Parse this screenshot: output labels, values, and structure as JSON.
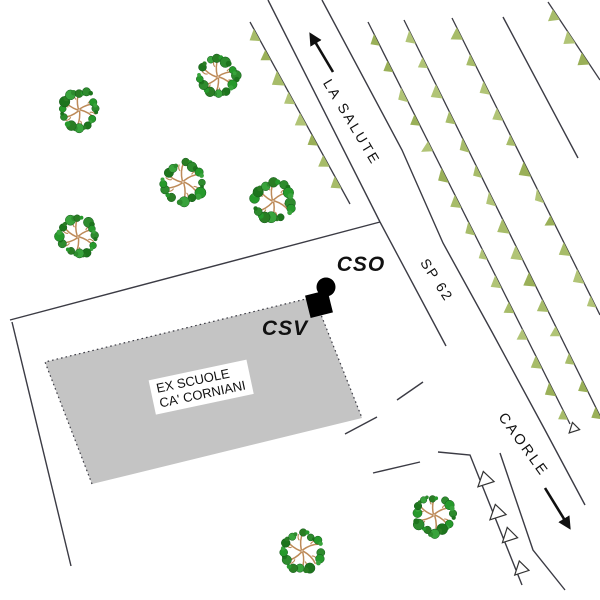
{
  "map": {
    "width": 600,
    "height": 600,
    "colors": {
      "background": "#ffffff",
      "line": "#3b3b44",
      "arrow": "#101010",
      "building_fill": "#c4c4c4",
      "building_outline": "#3b3b44",
      "marker": "#000000",
      "hedge_greens": [
        "#a7bc69",
        "#9ab058",
        "#b1c476"
      ],
      "tree_leaf_greens": [
        "#2e8b2e",
        "#26992b",
        "#1d741d",
        "#39a33c",
        "#2a7d24"
      ],
      "tree_branch": "#bd8a58",
      "white_triangle_fill": "#ffffff",
      "white_triangle_stroke": "#333333"
    },
    "labels": {
      "la_salute": {
        "text": "LA SALUTE",
        "x": 352,
        "y": 122,
        "rotate": 59,
        "size": 14,
        "spacing": 2.5,
        "weight": 400,
        "italic": false
      },
      "sp_62": {
        "text": "SP 62",
        "x": 437,
        "y": 280,
        "rotate": 57,
        "size": 14,
        "spacing": 2,
        "weight": 400,
        "italic": false
      },
      "caorle": {
        "text": "CAORLE",
        "x": 523,
        "y": 445,
        "rotate": 54,
        "size": 14.5,
        "spacing": 2.5,
        "weight": 400,
        "italic": false
      },
      "cso": {
        "text": "CSO",
        "x": 361,
        "y": 265,
        "rotate": 0,
        "size": 21,
        "spacing": 1,
        "weight": 700,
        "italic": true
      },
      "csv": {
        "text": "CSV",
        "x": 285,
        "y": 329,
        "rotate": 0,
        "size": 21,
        "spacing": 1,
        "weight": 700,
        "italic": true
      }
    },
    "building": {
      "points": [
        [
          45,
          362
        ],
        [
          314,
          297
        ],
        [
          362,
          418
        ],
        [
          92,
          484
        ]
      ],
      "label": {
        "line1": "EX SCUOLE",
        "line2": "CA' CORNIANI",
        "x": 201,
        "y": 387,
        "rotate": -12,
        "size": 13
      }
    },
    "site_marker": {
      "circle": {
        "cx": 326,
        "cy": 287,
        "r": 9.5
      },
      "square": {
        "cx": 319,
        "cy": 304,
        "size": 23,
        "rotate": -14
      }
    },
    "road_lines": [
      {
        "name": "parcel-boundary-top",
        "pts": [
          [
            10,
            320
          ],
          [
            380,
            222
          ]
        ]
      },
      {
        "name": "parcel-boundary-left",
        "pts": [
          [
            12,
            322
          ],
          [
            71,
            566
          ]
        ]
      },
      {
        "name": "road-left-edge-north",
        "pts": [
          [
            268,
            0
          ],
          [
            380,
            222
          ]
        ]
      },
      {
        "name": "road-left-edge-mid",
        "pts": [
          [
            380,
            222
          ],
          [
            446,
            346
          ]
        ]
      },
      {
        "name": "road-right-edge",
        "pts": [
          [
            322,
            0
          ],
          [
            402,
            150
          ],
          [
            443,
            243
          ],
          [
            492,
            332
          ],
          [
            545,
            430
          ],
          [
            585,
            505
          ]
        ]
      },
      {
        "name": "caorle-road-left-edge",
        "pts": [
          [
            500,
            453
          ],
          [
            533,
            550
          ],
          [
            565,
            590
          ]
        ]
      },
      {
        "name": "fence-polyline",
        "pts": [
          [
            438,
            452
          ],
          [
            470,
            455
          ],
          [
            522,
            585
          ]
        ]
      },
      {
        "name": "driveway-segment-1",
        "pts": [
          [
            397,
            400
          ],
          [
            423,
            382
          ]
        ]
      },
      {
        "name": "driveway-segment-2",
        "pts": [
          [
            345,
            434
          ],
          [
            377,
            417
          ]
        ]
      },
      {
        "name": "driveway-segment-3",
        "pts": [
          [
            373,
            473
          ],
          [
            420,
            462
          ]
        ]
      },
      {
        "name": "tree-row-plain-line",
        "pts": [
          [
            503,
            17
          ],
          [
            578,
            158
          ]
        ]
      }
    ],
    "hedges": [
      {
        "p1": [
          250,
          22
        ],
        "p2": [
          350,
          204
        ],
        "spacing": 24
      },
      {
        "p1": [
          368,
          22
        ],
        "p2": [
          570,
          424
        ],
        "spacing": 30
      },
      {
        "p1": [
          404,
          20
        ],
        "p2": [
          600,
          416
        ],
        "spacing": 30
      },
      {
        "p1": [
          452,
          18
        ],
        "p2": [
          600,
          315
        ],
        "spacing": 30
      },
      {
        "p1": [
          548,
          2
        ],
        "p2": [
          600,
          80
        ],
        "spacing": 26
      }
    ],
    "white_triangles": [
      {
        "x": 484,
        "y": 478,
        "w": 17,
        "h": 13,
        "rotate": -18
      },
      {
        "x": 496,
        "y": 511,
        "w": 17,
        "h": 13,
        "rotate": -18
      },
      {
        "x": 508,
        "y": 534,
        "w": 16,
        "h": 13,
        "rotate": -18
      },
      {
        "x": 520,
        "y": 567,
        "w": 15,
        "h": 12,
        "rotate": -18
      },
      {
        "x": 573,
        "y": 427,
        "w": 11,
        "h": 9,
        "rotate": -18
      }
    ],
    "arrows": [
      {
        "name": "arrow-to-la-salute",
        "x1": 333,
        "y1": 72,
        "x2": 311,
        "y2": 35
      },
      {
        "name": "arrow-to-caorle",
        "x1": 545,
        "y1": 488,
        "x2": 569,
        "y2": 527
      }
    ],
    "trees": [
      {
        "cx": 79,
        "cy": 110,
        "d": 44
      },
      {
        "cx": 218,
        "cy": 77,
        "d": 43
      },
      {
        "cx": 183,
        "cy": 182,
        "d": 46
      },
      {
        "cx": 78,
        "cy": 237,
        "d": 42
      },
      {
        "cx": 273,
        "cy": 201,
        "d": 45
      },
      {
        "cx": 434,
        "cy": 515,
        "d": 44
      },
      {
        "cx": 302,
        "cy": 551,
        "d": 44
      }
    ]
  }
}
